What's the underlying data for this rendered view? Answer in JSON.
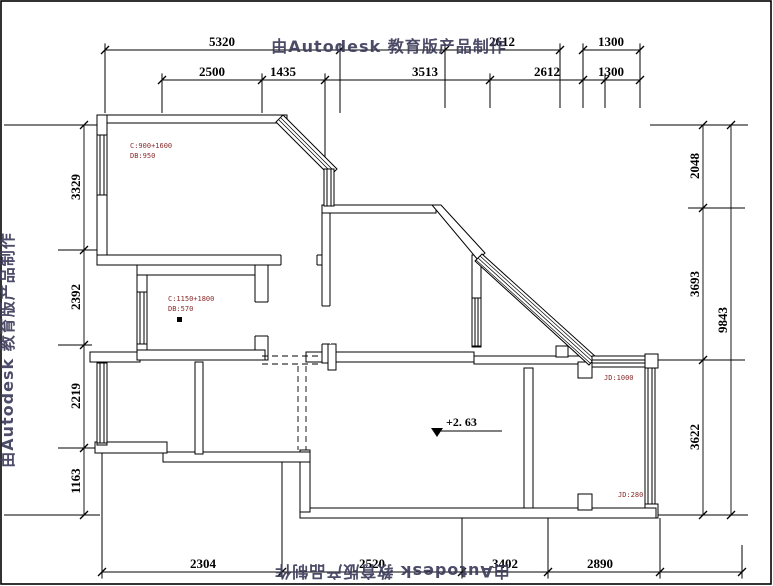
{
  "watermark": {
    "text": "由Autodesk 教育版产品制作",
    "color": "#3d3d5c"
  },
  "dims": {
    "top1": [
      "5320",
      "2612",
      "1300"
    ],
    "top2": [
      "2500",
      "1435",
      "3513",
      "2612",
      "1300"
    ],
    "left": [
      "3329",
      "2392",
      "2219",
      "1163"
    ],
    "right": [
      "2048",
      "3693",
      "3622"
    ],
    "right_total": "9843",
    "bottom": [
      "2304",
      "2520",
      "3402",
      "2890"
    ]
  },
  "annotations": {
    "room_a_line1": "C:900+1600",
    "room_a_line2": "DB:950",
    "room_b_line1": "C:1150+1800",
    "room_b_line2": "DB:570",
    "jd_top": "JD:1000",
    "jd_bottom": "JD:280",
    "elevation": "+2. 63"
  },
  "colors": {
    "line": "#000000",
    "annotation": "#8a2a2a",
    "watermark": "#3d3d5c"
  }
}
